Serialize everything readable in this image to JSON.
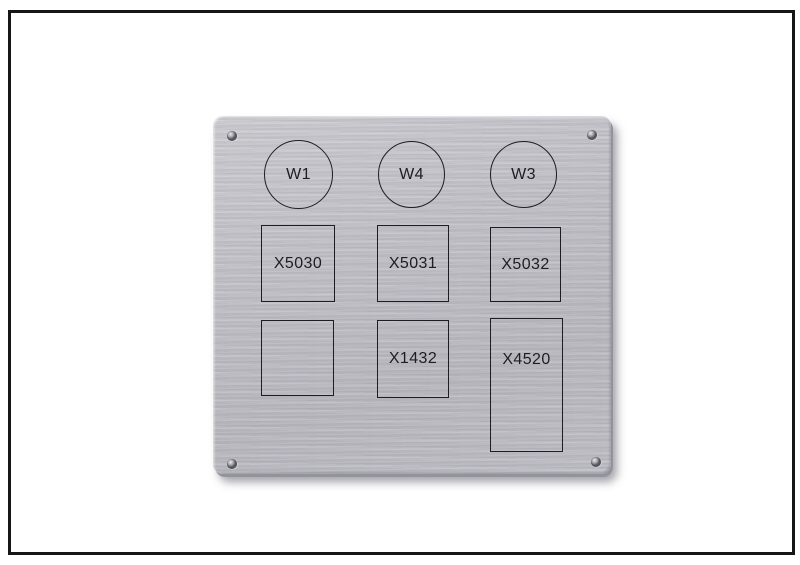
{
  "photo": {
    "description": "Framed photo of a brushed aluminum engraved front-panel label with corner screw holes",
    "colors": {
      "background": "#ffffff",
      "frame_border": "#161616",
      "panel_metal": "#bbbac1",
      "engraving": "#1d1d22"
    }
  },
  "panel": {
    "circle_markings": [
      {
        "label": "W1"
      },
      {
        "label": "W4"
      },
      {
        "label": "W3"
      }
    ],
    "rect_rows": [
      [
        {
          "label": "X5030"
        },
        {
          "label": "X5031"
        },
        {
          "label": "X5032"
        }
      ],
      [
        {
          "label": ""
        },
        {
          "label": "X1432"
        },
        {
          "label": "X4520"
        }
      ]
    ],
    "screw_holes": [
      "top-left",
      "top-right",
      "bottom-left",
      "bottom-right"
    ]
  }
}
